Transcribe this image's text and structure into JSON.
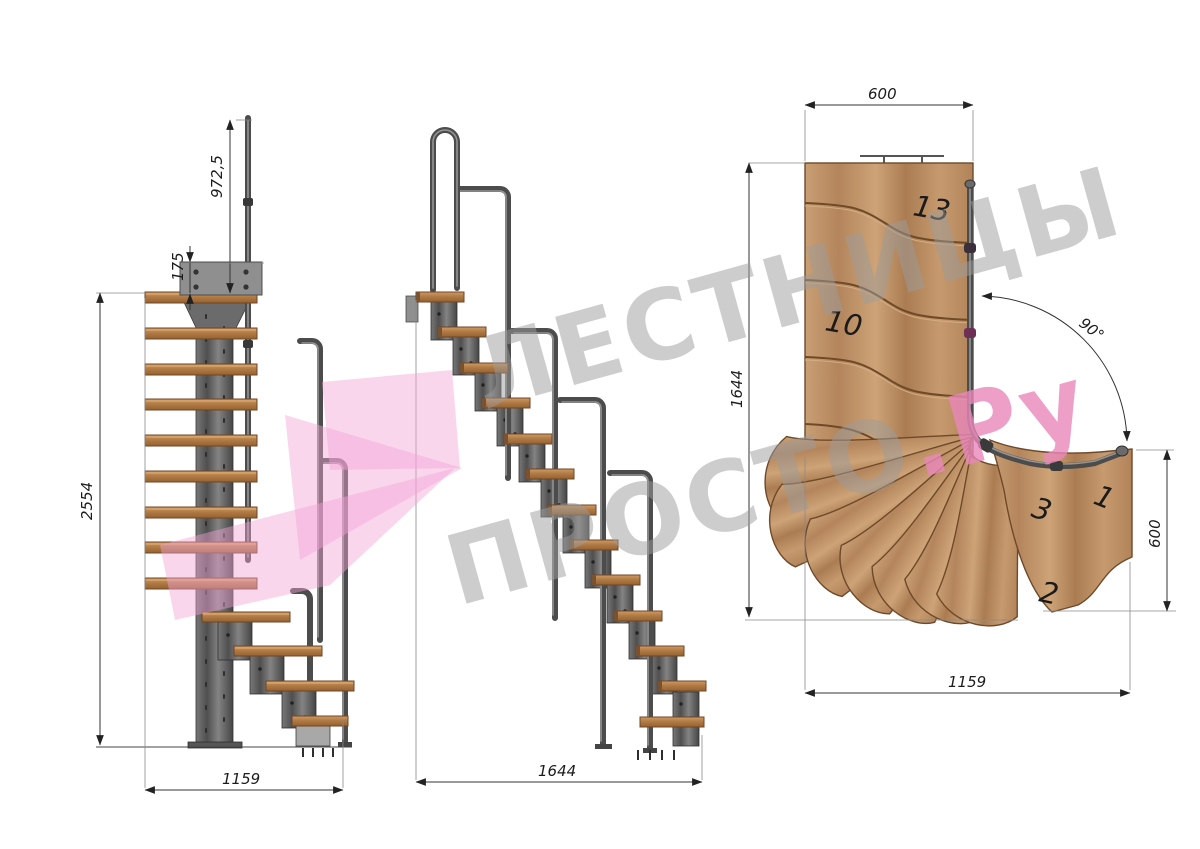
{
  "watermark": {
    "line1": "ЛЕСТНИЦЫ",
    "line2_gray": "ПРОСТО",
    "line2_accent": ".Ру",
    "gray_color": "#9c9c9c",
    "accent_color": "#e987ba",
    "arrow_color": "#f3a3d6"
  },
  "side_view": {
    "dim_handrail_height": "972,5",
    "dim_plate_height": "175",
    "dim_total_height": "2554",
    "dim_run_length": "1159"
  },
  "front_view": {
    "dim_run_length": "1644"
  },
  "plan_view": {
    "dim_top_width": "600",
    "dim_left_depth": "1644",
    "dim_entry_depth": "600",
    "dim_bottom_width": "1159",
    "dim_turn_angle": "90°",
    "labels": {
      "s13": "13",
      "s10": "10",
      "s3": "3",
      "s1": "1",
      "s2": "2"
    }
  },
  "palette": {
    "wood": "#c1976c",
    "wood_dark": "#6e4a2a",
    "metal": "#5a5a5a",
    "dimension_color": "#222222"
  }
}
